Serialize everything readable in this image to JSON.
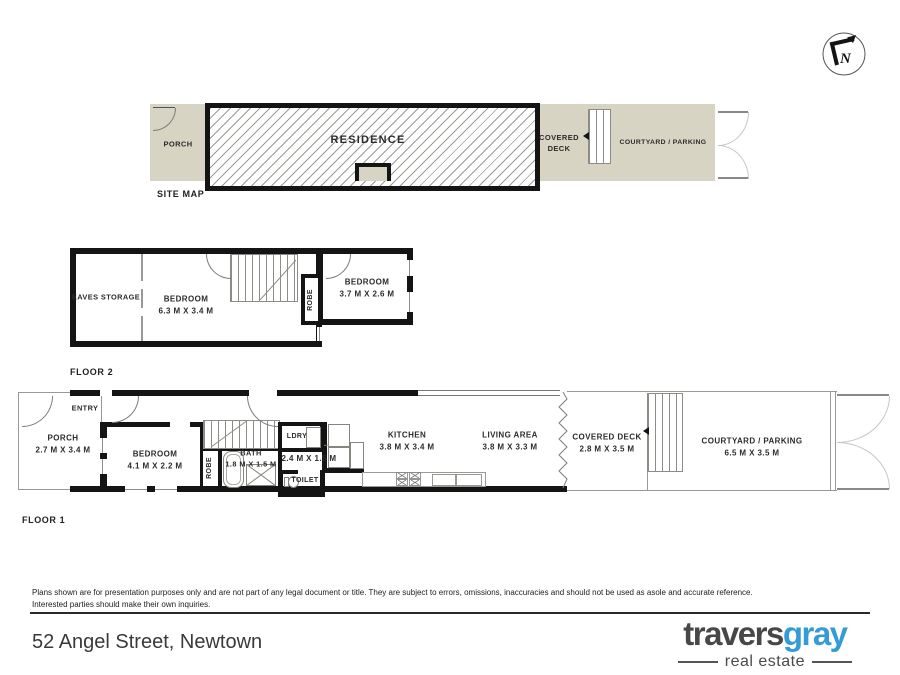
{
  "compass": {
    "letter": "N"
  },
  "site_map": {
    "title": "SITE MAP",
    "porch": "PORCH",
    "residence": "RESIDENCE",
    "covered_deck_line1": "COVERED",
    "covered_deck_line2": "DECK",
    "courtyard": "COURTYARD / PARKING"
  },
  "floor2": {
    "title": "FLOOR 2",
    "eaves_storage": "EAVES STORAGE",
    "bedroom1_name": "BEDROOM",
    "bedroom1_dims": "6.3 M X 3.4 M",
    "robe": "ROBE",
    "bedroom2_name": "BEDROOM",
    "bedroom2_dims": "3.7 M X 2.6 M"
  },
  "floor1": {
    "title": "FLOOR 1",
    "entry": "ENTRY",
    "porch_name": "PORCH",
    "porch_dims": "2.7 M X 3.4 M",
    "bedroom_name": "BEDROOM",
    "bedroom_dims": "4.1 M X 2.2 M",
    "robe": "ROBE",
    "bath_name": "BATH",
    "bath_dims": "1.8 M X 1.5 M",
    "ldry": "LDRY",
    "hall_dims": "2.4 M X 1.6 M",
    "toilet": "TOILET",
    "kitchen_name": "KITCHEN",
    "kitchen_dims": "3.8 M X 3.4 M",
    "living_name": "LIVING AREA",
    "living_dims": "3.8 M X 3.3 M",
    "deck_name": "COVERED DECK",
    "deck_dims": "2.8 M X 3.5 M",
    "courtyard_name": "COURTYARD / PARKING",
    "courtyard_dims": "6.5 M X 3.5 M"
  },
  "footer": {
    "disclaimer_line1": "Plans shown are for presentation purposes only and are not part of any legal document or title.  They are subject to errors, omissions, inaccuracies and should not be used as asole and accurate reference.",
    "disclaimer_line2": "Interested parties should make their own inquiries.",
    "address": "52 Angel Street, Newtown",
    "brand_part1": "travers",
    "brand_part2": "gray",
    "brand_tagline": "real estate"
  },
  "colors": {
    "site_fill": "#d8d4c3",
    "wall": "#141414",
    "brand_accent": "#359bd6"
  }
}
